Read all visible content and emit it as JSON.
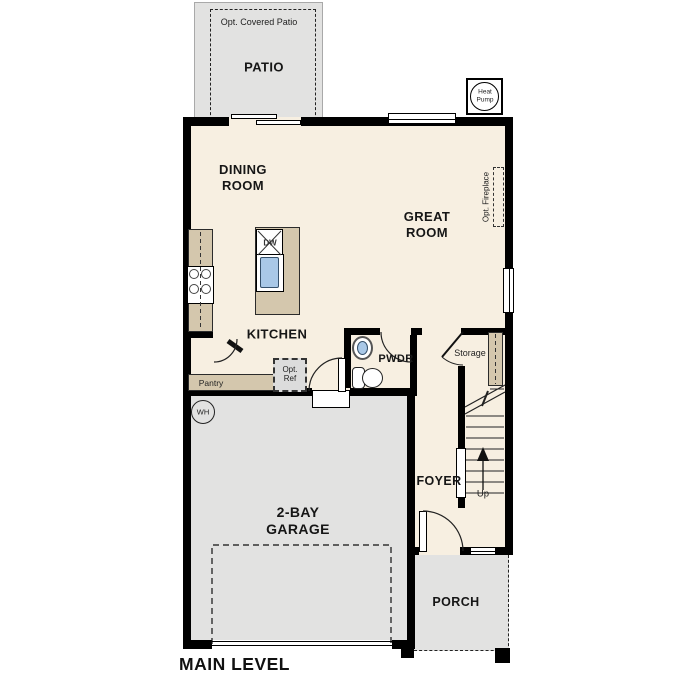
{
  "plan": {
    "title": "MAIN LEVEL",
    "patio": {
      "note": "Opt. Covered Patio",
      "label": "PATIO"
    },
    "heat_pump": {
      "line1": "Heat",
      "line2": "Pump"
    },
    "dining": {
      "line1": "DINING",
      "line2": "ROOM"
    },
    "great": {
      "line1": "GREAT",
      "line2": "ROOM"
    },
    "fireplace": {
      "label": "Opt. Fireplace"
    },
    "kitchen": {
      "label": "KITCHEN",
      "island_dw": "DW",
      "pantry": "Pantry",
      "opt_ref_line1": "Opt.",
      "opt_ref_line2": "Ref"
    },
    "pwdr": {
      "label": "PWDR"
    },
    "storage": {
      "label": "Storage"
    },
    "stairs": {
      "up": "Up"
    },
    "foyer": {
      "label": "FOYER"
    },
    "garage": {
      "line1": "2-BAY",
      "line2": "GARAGE",
      "wh": "WH"
    },
    "porch": {
      "label": "PORCH"
    },
    "colors": {
      "floor": "#f7efe1",
      "hardscape": "#e2e2e1",
      "counter": "#d4c7ad",
      "sink": "#a9c8e7",
      "wall": "#000000"
    }
  }
}
